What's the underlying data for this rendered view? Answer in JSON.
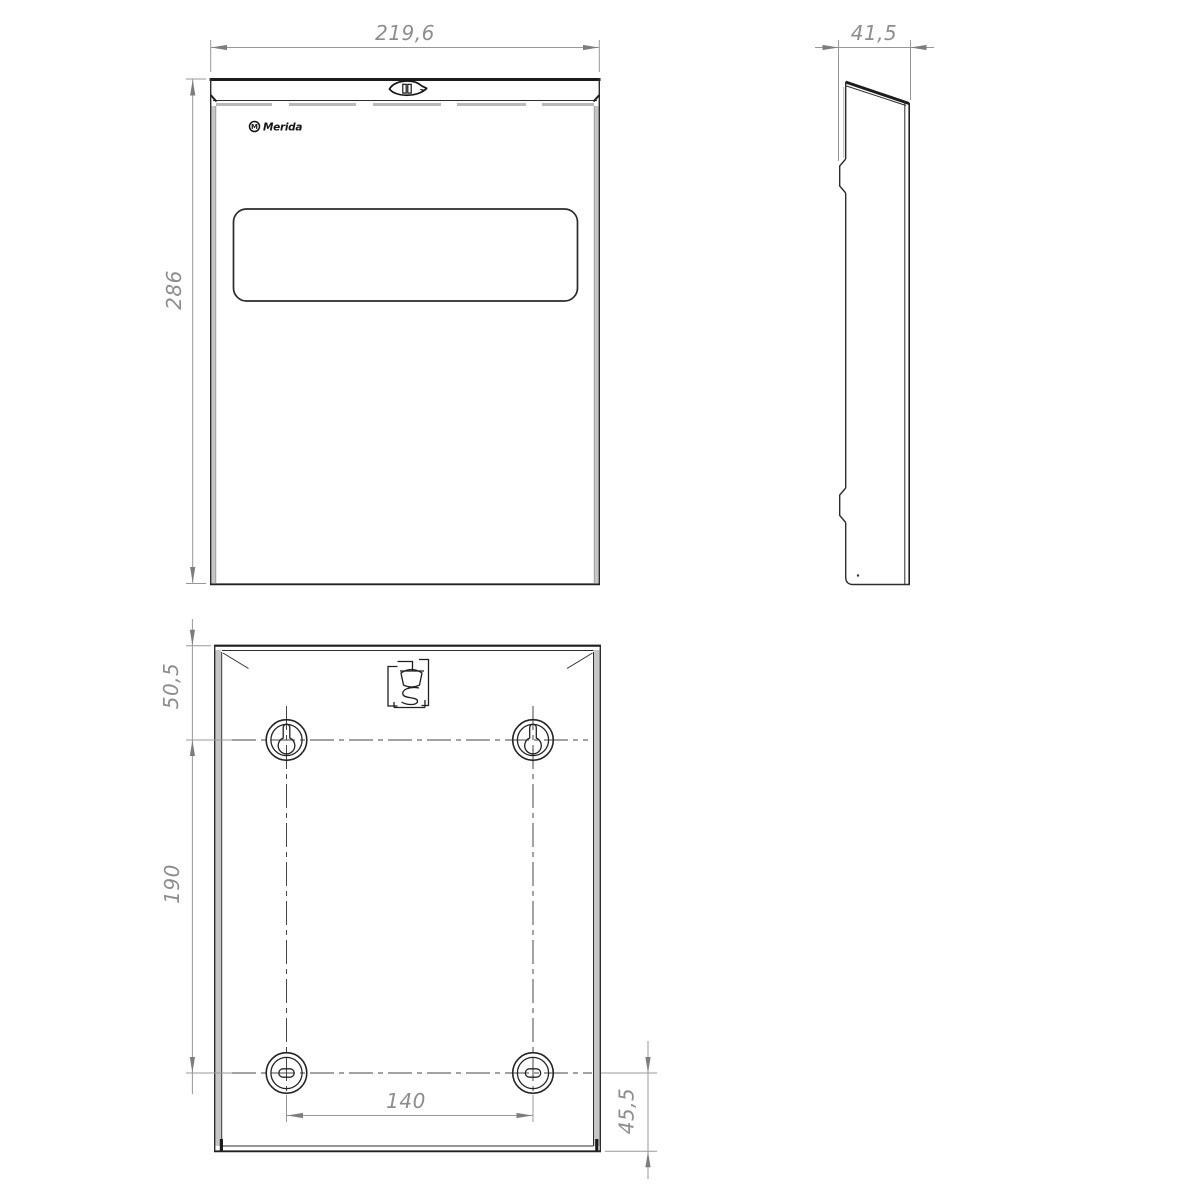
{
  "drawing": {
    "brand": {
      "logo_text": "Merida",
      "logo_mark": "M"
    },
    "colors": {
      "background": "#ffffff",
      "object_line": "#2d2d2d",
      "thick_edge": "#1c1c1c",
      "edge_shading": "#c6c6c6",
      "dimension_line": "#989898",
      "dimension_text": "#8d8d8d",
      "centerline": "#454545"
    },
    "views": {
      "front": {
        "dimensions": {
          "width": "219,6",
          "height": "286"
        }
      },
      "side": {
        "dimensions": {
          "depth": "41,5"
        }
      },
      "back": {
        "dimensions": {
          "hole_top_offset": "50,5",
          "hole_vertical_spacing": "190",
          "hole_horizontal_spacing": "140",
          "hole_bottom_offset": "45,5"
        }
      }
    }
  }
}
